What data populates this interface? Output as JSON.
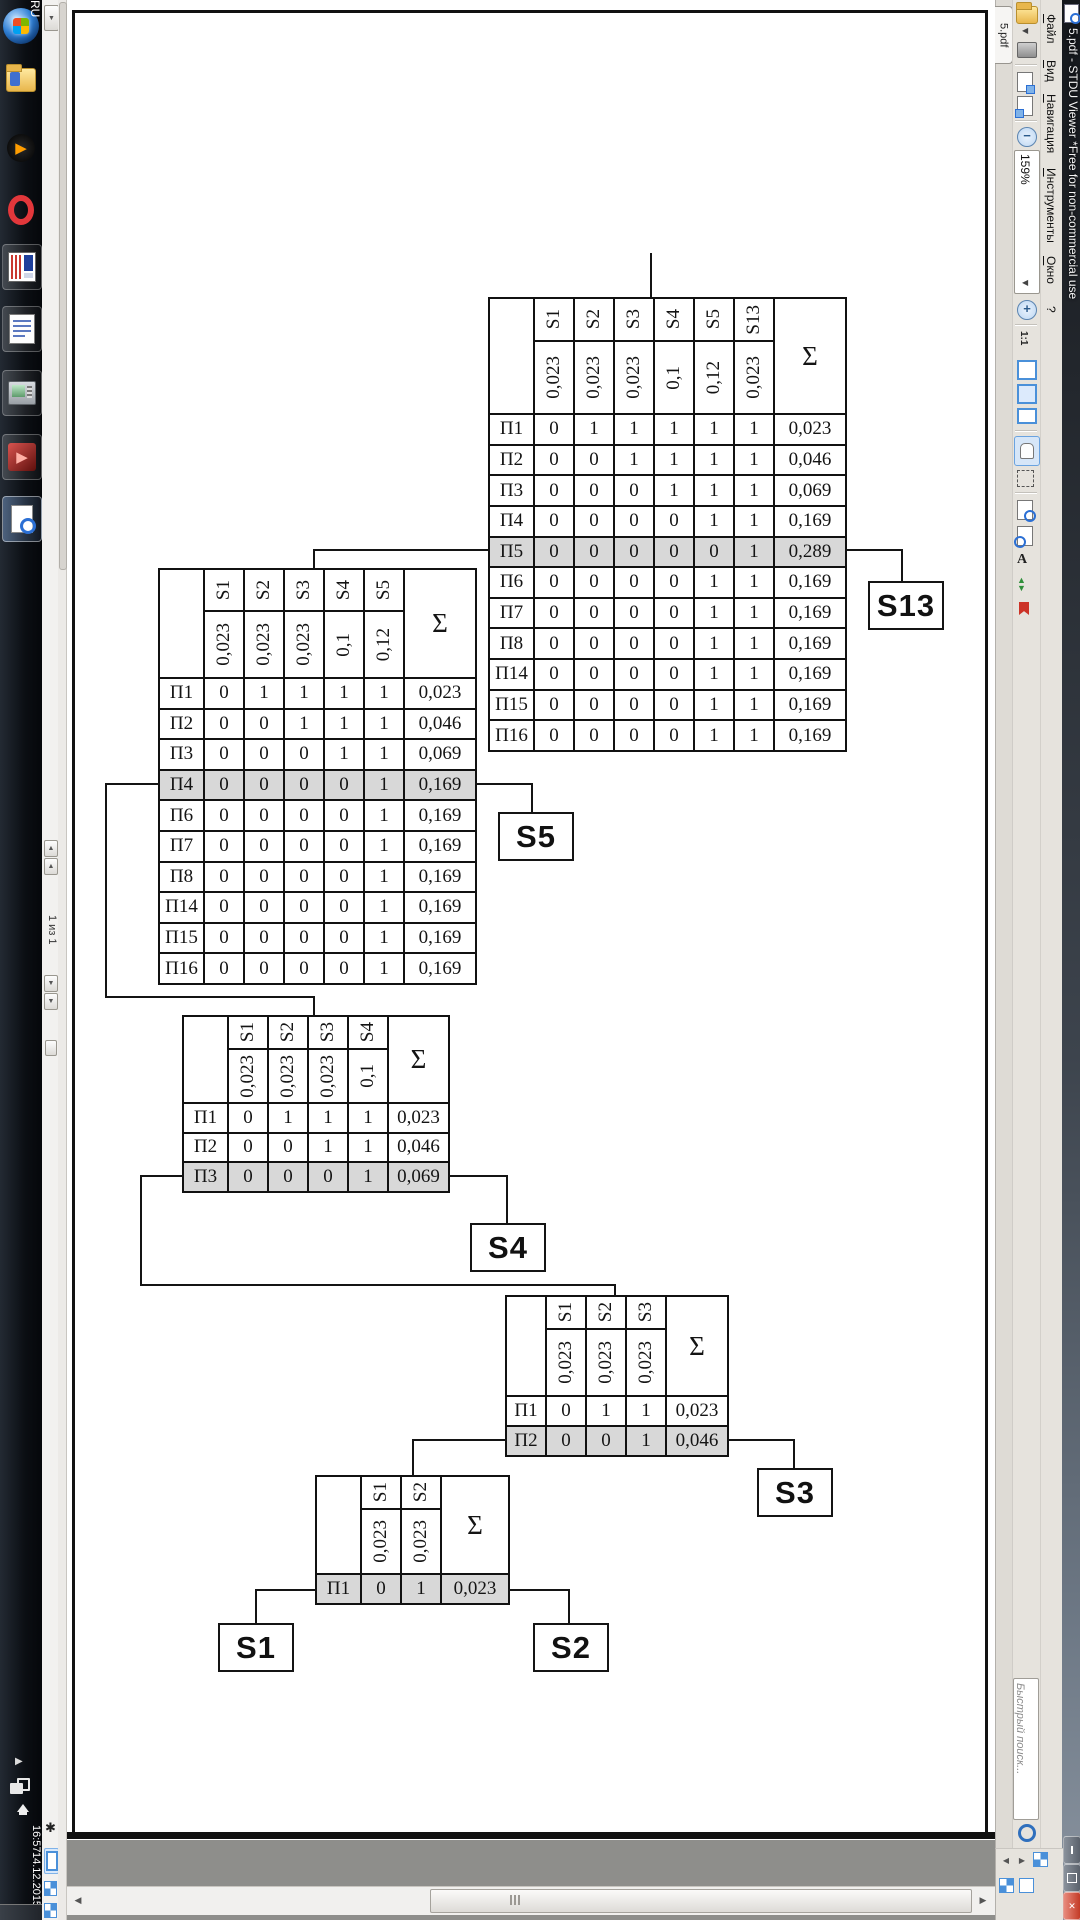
{
  "window": {
    "title": "5.pdf - STDU Viewer *Free for non-commercial use",
    "tab": "5.pdf"
  },
  "menu": {
    "items": [
      "Файл",
      "Вид",
      "Навигация",
      "Инструменты",
      "Окно",
      "?"
    ]
  },
  "toolbar": {
    "zoom_value": "159%",
    "actual_size_label": "1:1",
    "search_placeholder": "Быстрый поиск..."
  },
  "statusbar": {
    "page_indicator": "1 из 1"
  },
  "tray": {
    "language": "RU",
    "time": "16:57",
    "date": "14.12.2015"
  },
  "colors": {
    "shaded_row": "#d8d8d8",
    "selection_blue": "#4a90d9",
    "close_red": "#c33a26"
  },
  "diagram": {
    "root_label": "A",
    "sum_header": "Σ",
    "leaves": [
      {
        "id": "S13",
        "label": "S13"
      },
      {
        "id": "S5",
        "label": "S5"
      },
      {
        "id": "S4",
        "label": "S4"
      },
      {
        "id": "S3",
        "label": "S3"
      },
      {
        "id": "S1",
        "label": "S1"
      },
      {
        "id": "S2",
        "label": "S2"
      }
    ],
    "tables": [
      {
        "id": "t1",
        "col_headers": [
          "S1",
          "S2",
          "S3",
          "S4",
          "S5",
          "S13"
        ],
        "col_weights": [
          "0,023",
          "0,023",
          "0,023",
          "0,1",
          "0,12",
          "0,023"
        ],
        "rows": [
          {
            "label": "П1",
            "cells": [
              "0",
              "1",
              "1",
              "1",
              "1",
              "1"
            ],
            "sum": "0,023",
            "shaded": false
          },
          {
            "label": "П2",
            "cells": [
              "0",
              "0",
              "1",
              "1",
              "1",
              "1"
            ],
            "sum": "0,046",
            "shaded": false
          },
          {
            "label": "П3",
            "cells": [
              "0",
              "0",
              "0",
              "1",
              "1",
              "1"
            ],
            "sum": "0,069",
            "shaded": false
          },
          {
            "label": "П4",
            "cells": [
              "0",
              "0",
              "0",
              "0",
              "1",
              "1"
            ],
            "sum": "0,169",
            "shaded": false
          },
          {
            "label": "П5",
            "cells": [
              "0",
              "0",
              "0",
              "0",
              "0",
              "1"
            ],
            "sum": "0,289",
            "shaded": true
          },
          {
            "label": "П6",
            "cells": [
              "0",
              "0",
              "0",
              "0",
              "1",
              "1"
            ],
            "sum": "0,169",
            "shaded": false
          },
          {
            "label": "П7",
            "cells": [
              "0",
              "0",
              "0",
              "0",
              "1",
              "1"
            ],
            "sum": "0,169",
            "shaded": false
          },
          {
            "label": "П8",
            "cells": [
              "0",
              "0",
              "0",
              "0",
              "1",
              "1"
            ],
            "sum": "0,169",
            "shaded": false
          },
          {
            "label": "П14",
            "cells": [
              "0",
              "0",
              "0",
              "0",
              "1",
              "1"
            ],
            "sum": "0,169",
            "shaded": false
          },
          {
            "label": "П15",
            "cells": [
              "0",
              "0",
              "0",
              "0",
              "1",
              "1"
            ],
            "sum": "0,169",
            "shaded": false
          },
          {
            "label": "П16",
            "cells": [
              "0",
              "0",
              "0",
              "0",
              "1",
              "1"
            ],
            "sum": "0,169",
            "shaded": false
          }
        ]
      },
      {
        "id": "t2",
        "col_headers": [
          "S1",
          "S2",
          "S3",
          "S4",
          "S5"
        ],
        "col_weights": [
          "0,023",
          "0,023",
          "0,023",
          "0,1",
          "0,12"
        ],
        "rows": [
          {
            "label": "П1",
            "cells": [
              "0",
              "1",
              "1",
              "1",
              "1"
            ],
            "sum": "0,023",
            "shaded": false
          },
          {
            "label": "П2",
            "cells": [
              "0",
              "0",
              "1",
              "1",
              "1"
            ],
            "sum": "0,046",
            "shaded": false
          },
          {
            "label": "П3",
            "cells": [
              "0",
              "0",
              "0",
              "1",
              "1"
            ],
            "sum": "0,069",
            "shaded": false
          },
          {
            "label": "П4",
            "cells": [
              "0",
              "0",
              "0",
              "0",
              "1"
            ],
            "sum": "0,169",
            "shaded": true
          },
          {
            "label": "П6",
            "cells": [
              "0",
              "0",
              "0",
              "0",
              "1"
            ],
            "sum": "0,169",
            "shaded": false
          },
          {
            "label": "П7",
            "cells": [
              "0",
              "0",
              "0",
              "0",
              "1"
            ],
            "sum": "0,169",
            "shaded": false
          },
          {
            "label": "П8",
            "cells": [
              "0",
              "0",
              "0",
              "0",
              "1"
            ],
            "sum": "0,169",
            "shaded": false
          },
          {
            "label": "П14",
            "cells": [
              "0",
              "0",
              "0",
              "0",
              "1"
            ],
            "sum": "0,169",
            "shaded": false
          },
          {
            "label": "П15",
            "cells": [
              "0",
              "0",
              "0",
              "0",
              "1"
            ],
            "sum": "0,169",
            "shaded": false
          },
          {
            "label": "П16",
            "cells": [
              "0",
              "0",
              "0",
              "0",
              "1"
            ],
            "sum": "0,169",
            "shaded": false
          }
        ]
      },
      {
        "id": "t3",
        "col_headers": [
          "S1",
          "S2",
          "S3",
          "S4"
        ],
        "col_weights": [
          "0,023",
          "0,023",
          "0,023",
          "0,1"
        ],
        "rows": [
          {
            "label": "П1",
            "cells": [
              "0",
              "1",
              "1",
              "1"
            ],
            "sum": "0,023",
            "shaded": false
          },
          {
            "label": "П2",
            "cells": [
              "0",
              "0",
              "1",
              "1"
            ],
            "sum": "0,046",
            "shaded": false
          },
          {
            "label": "П3",
            "cells": [
              "0",
              "0",
              "0",
              "1"
            ],
            "sum": "0,069",
            "shaded": true
          }
        ]
      },
      {
        "id": "t4",
        "col_headers": [
          "S1",
          "S2",
          "S3"
        ],
        "col_weights": [
          "0,023",
          "0,023",
          "0,023"
        ],
        "rows": [
          {
            "label": "П1",
            "cells": [
              "0",
              "1",
              "1"
            ],
            "sum": "0,023",
            "shaded": false
          },
          {
            "label": "П2",
            "cells": [
              "0",
              "0",
              "1"
            ],
            "sum": "0,046",
            "shaded": true
          }
        ]
      },
      {
        "id": "t5",
        "col_headers": [
          "S1",
          "S2"
        ],
        "col_weights": [
          "0,023",
          "0,023"
        ],
        "rows": [
          {
            "label": "П1",
            "cells": [
              "0",
              "1"
            ],
            "sum": "0,023",
            "shaded": true
          }
        ]
      }
    ]
  }
}
